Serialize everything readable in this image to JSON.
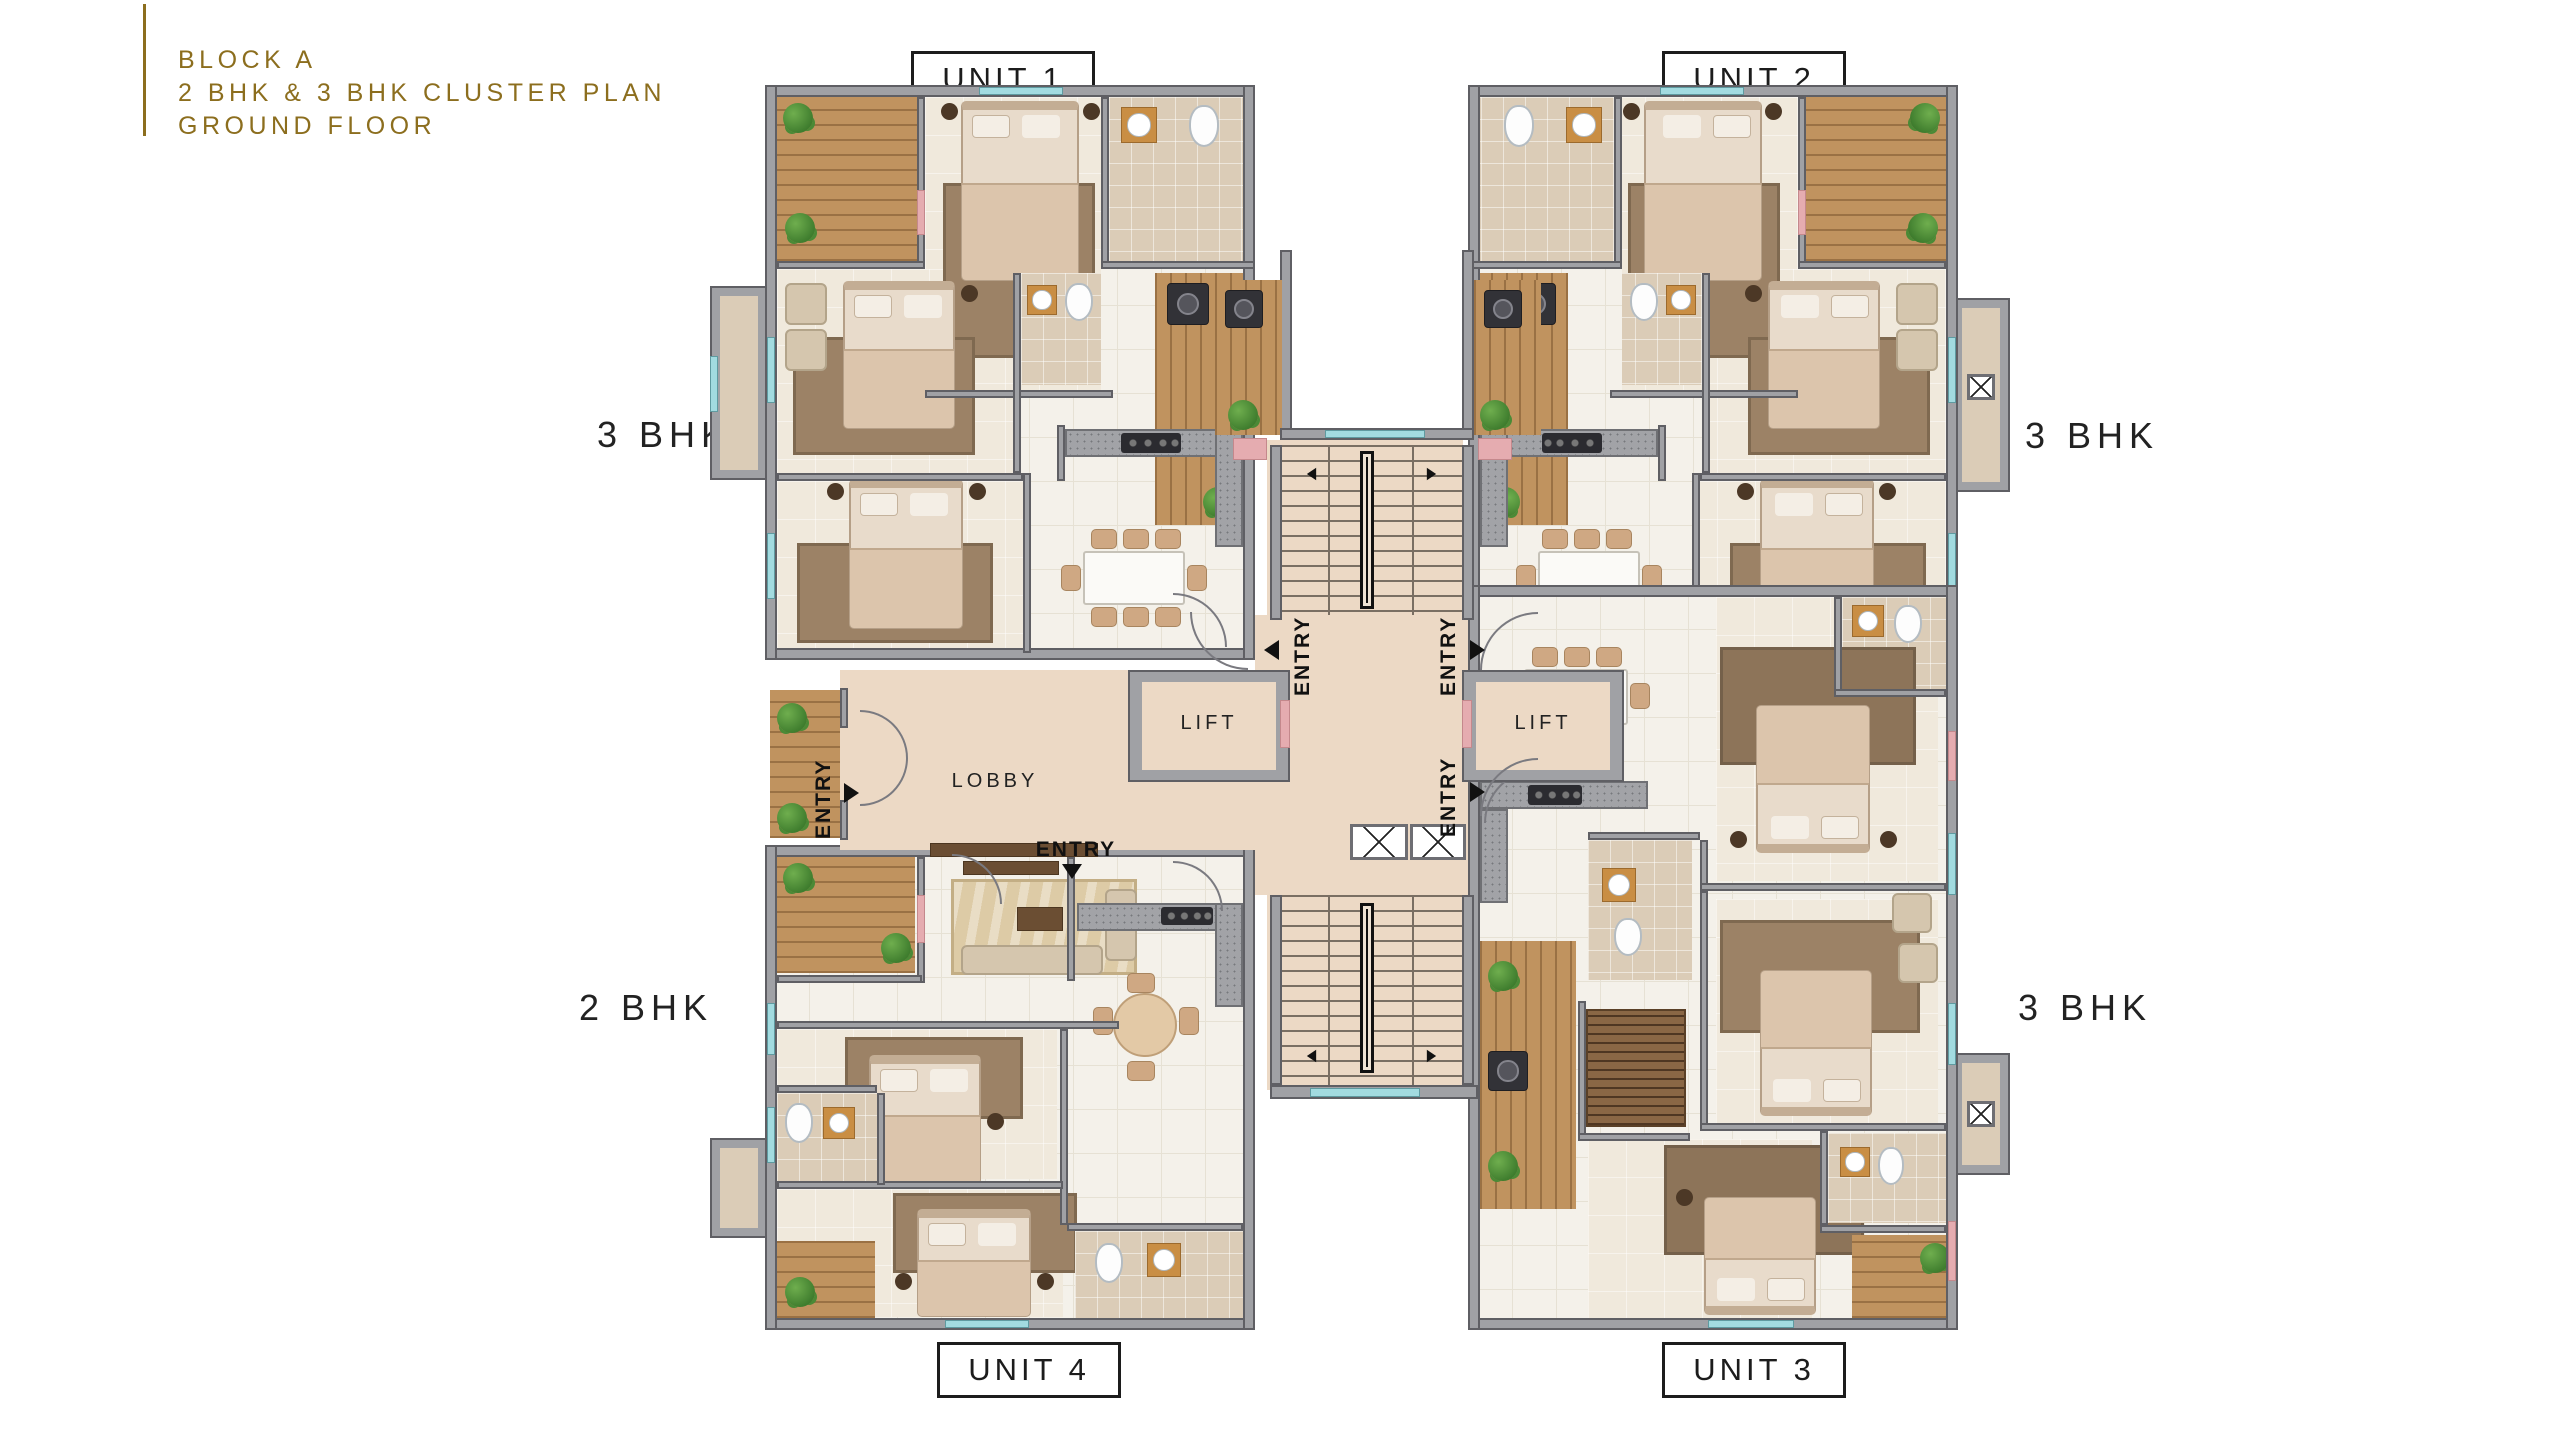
{
  "title": {
    "line1": "BLOCK A",
    "line2": "2 BHK & 3 BHK CLUSTER PLAN",
    "line3": "GROUND FLOOR"
  },
  "unit_labels": {
    "unit1": "UNIT 1",
    "unit2": "UNIT 2",
    "unit3": "UNIT 3",
    "unit4": "UNIT 4"
  },
  "type_labels": {
    "unit1": "3 BHK",
    "unit2": "3 BHK",
    "unit3": "3 BHK",
    "unit4": "2 BHK"
  },
  "core_labels": {
    "lift_left": "LIFT",
    "lift_right": "LIFT",
    "lobby": "LOBBY"
  },
  "entry_labels": {
    "lobby": "ENTRY",
    "unit1": "ENTRY",
    "unit2": "ENTRY",
    "unit3": "ENTRY",
    "unit4": "ENTRY"
  },
  "colors": {
    "title_gold": "#8c6e1e",
    "label_ink": "#1c1c1c",
    "wall_gray": "#a0a1a5",
    "wall_edge": "#5f5f64",
    "floor_tile": "#f4f1ea",
    "floor_bath": "#dbccb7",
    "floor_corridor": "#ecd9c5",
    "wood": "#c0935f",
    "rug_brown": "#9c8266",
    "rug_living": "#ddcba6",
    "accent_pink": "#e5acb0",
    "window_teal": "#a2dbe0",
    "plant_green": "#4a8a36"
  }
}
